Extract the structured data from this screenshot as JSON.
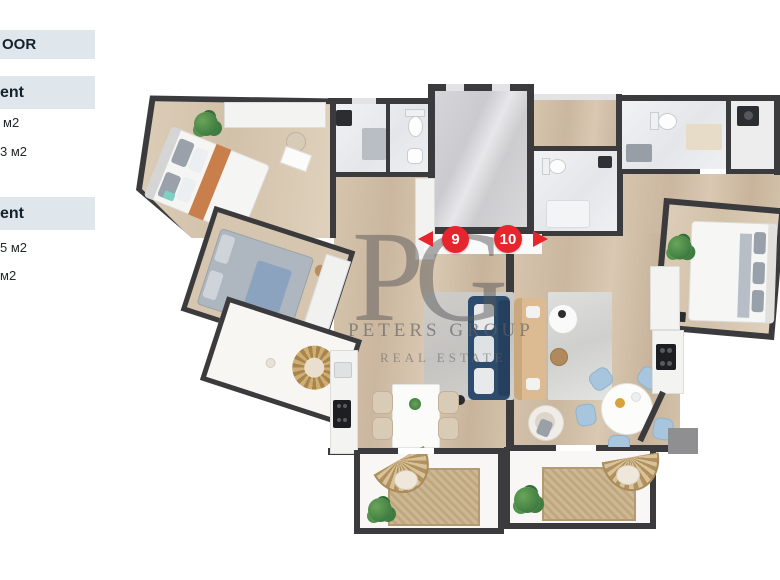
{
  "sidebar": {
    "floor_header_fragment": "OOR",
    "sections": [
      {
        "title_fragment": "ent",
        "rows": [
          "м2",
          "3 м2"
        ]
      },
      {
        "title_fragment": "ent",
        "rows": [
          "5 м2",
          "м2"
        ]
      }
    ]
  },
  "watermark": {
    "monogram": "PG",
    "name": "PETERS GROUP",
    "tagline": "REAL ESTATE"
  },
  "markers": {
    "left": {
      "label": "9"
    },
    "right": {
      "label": "10"
    }
  },
  "palette": {
    "wall": "#3b3b3e",
    "wood": "#cfbca5",
    "tile": "#edeef1",
    "marker_red": "#e8252c",
    "sofa_navy": "#2c4b6d",
    "sofa_tan": "#dcbb92",
    "chair_blue": "#a7c6dd",
    "chair_beige": "#d9ccb7",
    "rug_jute": "#c7b28d",
    "sidebar_band": "#dfe7ed"
  }
}
